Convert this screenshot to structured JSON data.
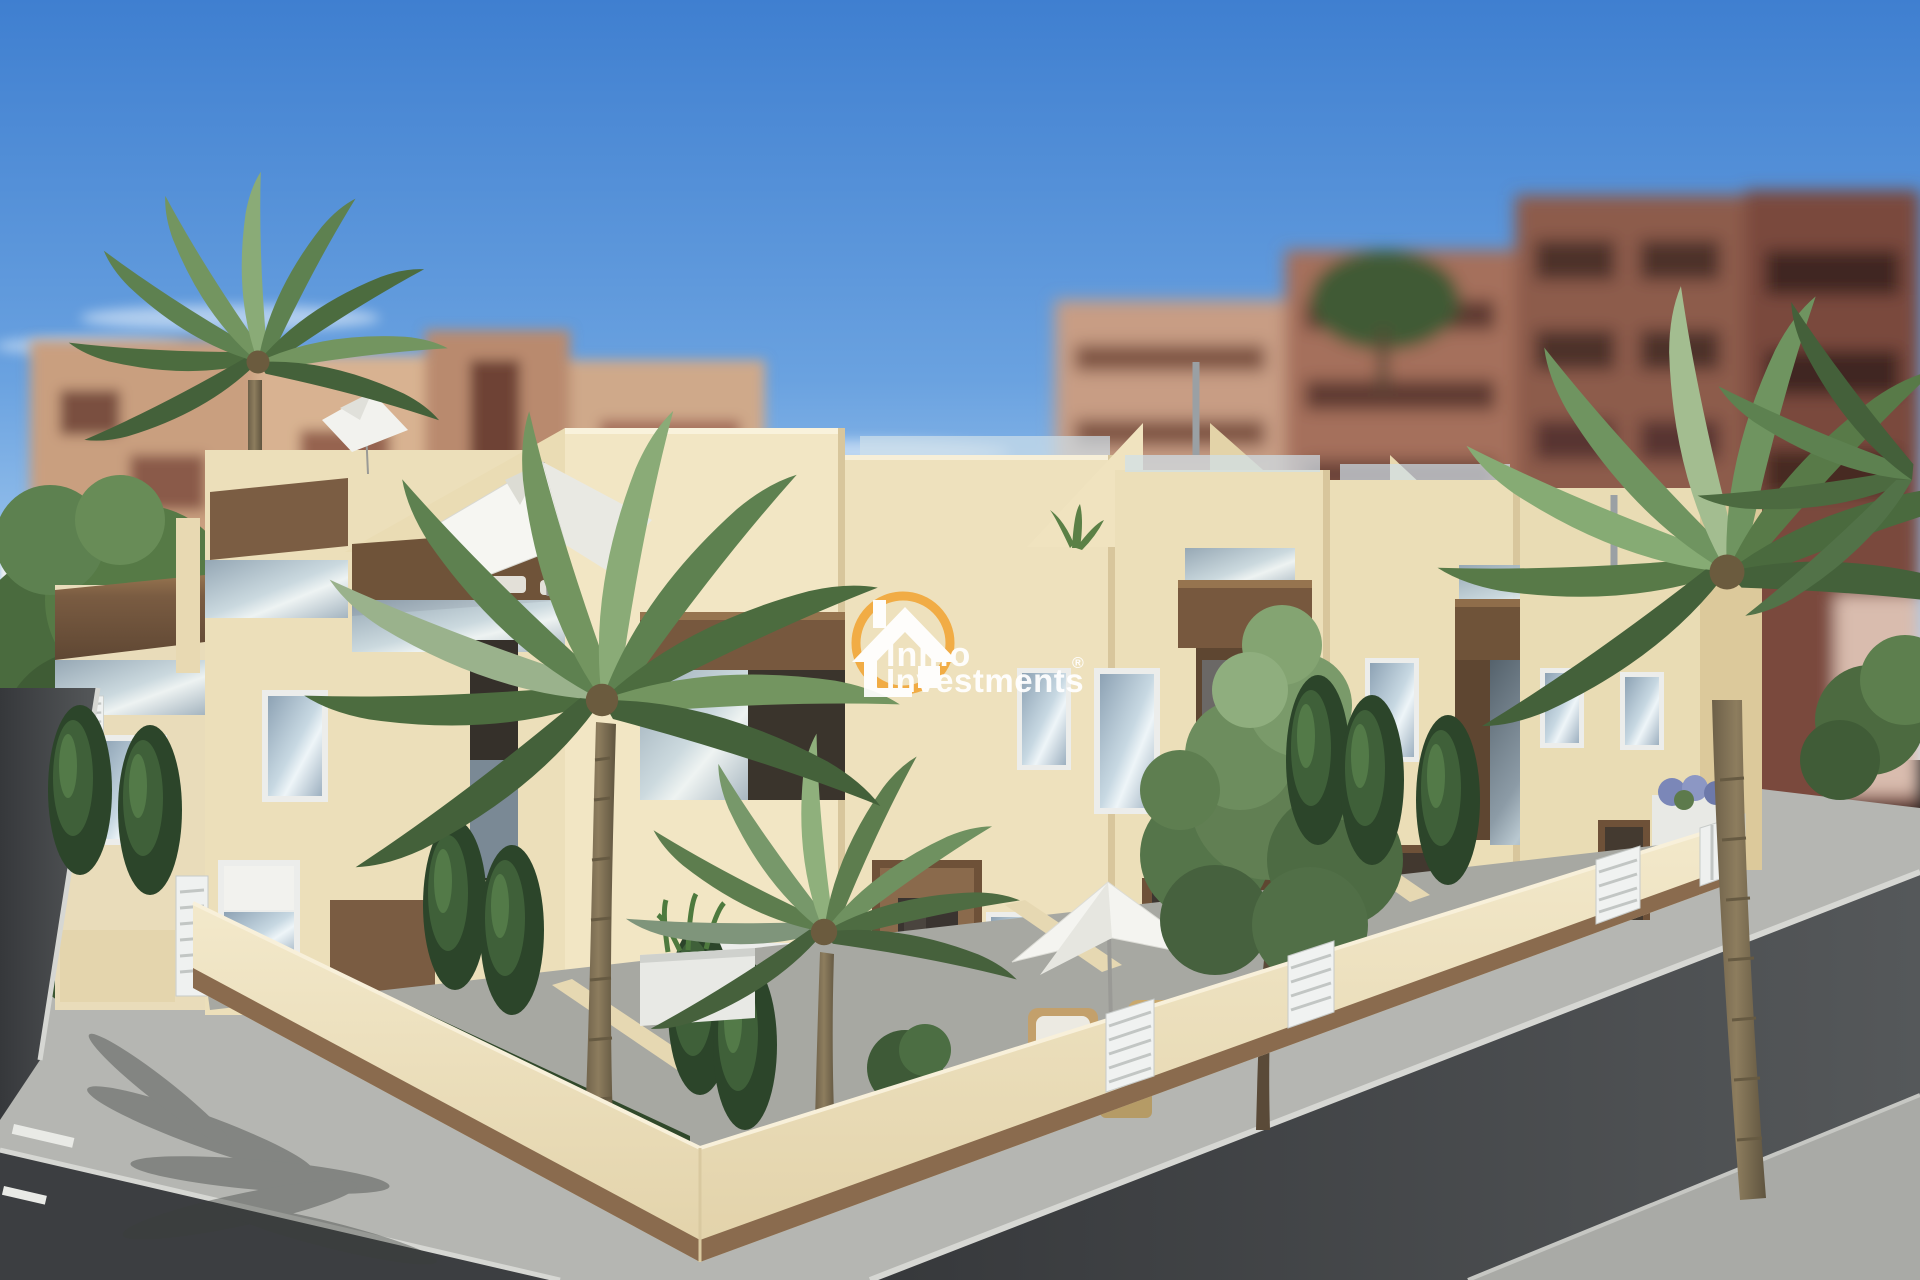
{
  "watermark": {
    "brand_line1": "Inmo",
    "brand_line2": "Investments",
    "registered_mark": "®",
    "icon": "house-in-circle-icon",
    "ring_color": "#F1A83C",
    "text_color": "#FFFFFF"
  },
  "palette": {
    "sky_top": "#3F7FD0",
    "sky_horizon": "#D4E9F8",
    "facade_cream": "#F2E6C4",
    "facade_shade": "#D8C69B",
    "wood_accent": "#77583E",
    "glass_blue": "#9FB3C4",
    "road_asphalt": "#3F4144",
    "sidewalk_gray": "#B5B6B2",
    "foliage_green": "#5E8150",
    "background_buildings": "#9C6A57",
    "perimeter_wall": "#F0E5C5",
    "wall_base_trim": "#8A6B4E"
  }
}
